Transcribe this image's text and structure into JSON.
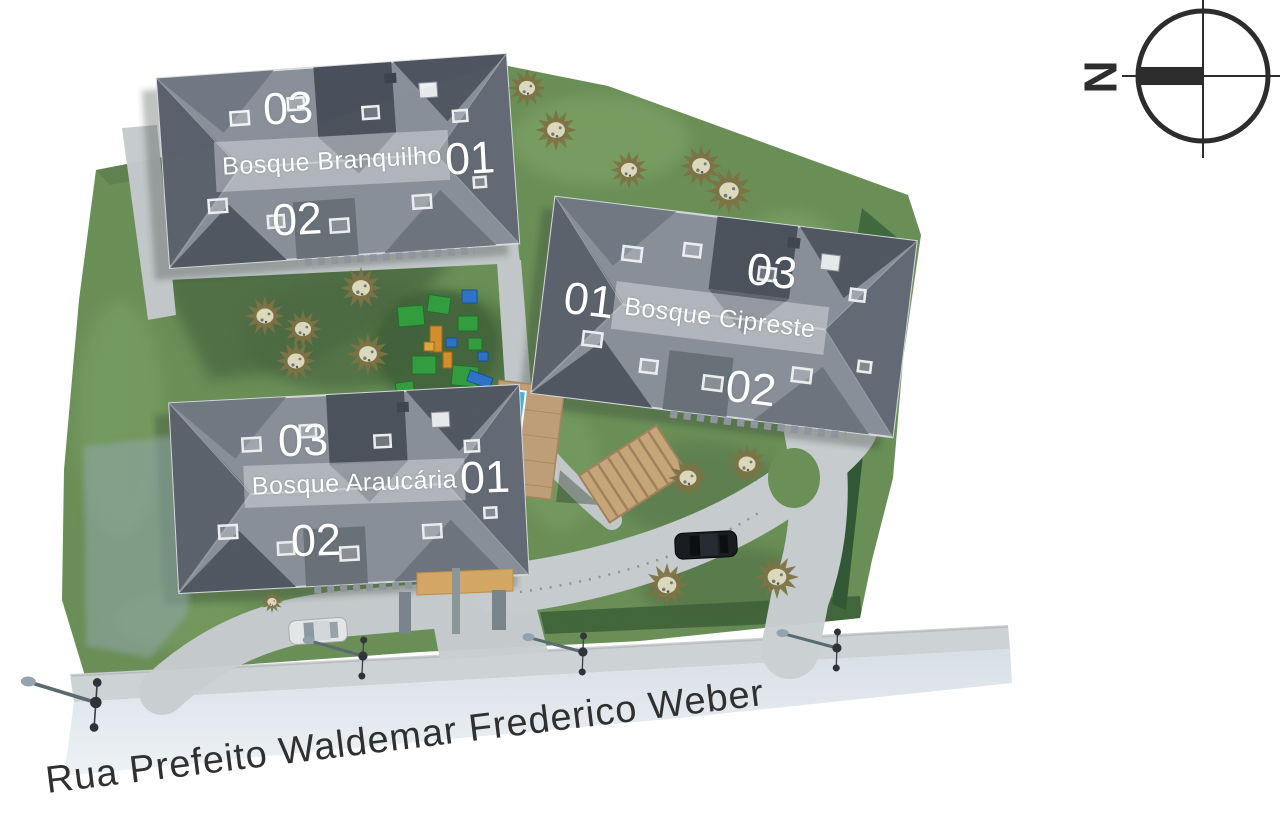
{
  "map": {
    "street_label": "Rua Prefeito Waldemar Frederico Weber",
    "compass": {
      "north_label": "N"
    }
  },
  "buildings": [
    {
      "name": "Bosque Branquilho",
      "units": {
        "top": "03",
        "right": "01",
        "bottom": "02"
      }
    },
    {
      "name": "Bosque Cipreste",
      "units": {
        "left": "01",
        "top": "03",
        "bottom": "02"
      }
    },
    {
      "name": "Bosque Araucária",
      "units": {
        "top": "03",
        "right": "01",
        "bottom": "02"
      }
    }
  ],
  "colors": {
    "grass": "#699055",
    "grass_dark": "#48683f",
    "roof": "#8a909a",
    "roof_dark": "#4e5560",
    "path": "#c6cbce",
    "sidewalk": "#cdd2d4",
    "street": "#e3e9ee",
    "tree": "#7e7242",
    "hedge": "#2e5531",
    "pool_water": "#45b4d6",
    "wood_deck": "#c9a87a",
    "entrance_wall": "#d9a963",
    "label_text": "#ffffff",
    "street_text": "#303030"
  }
}
